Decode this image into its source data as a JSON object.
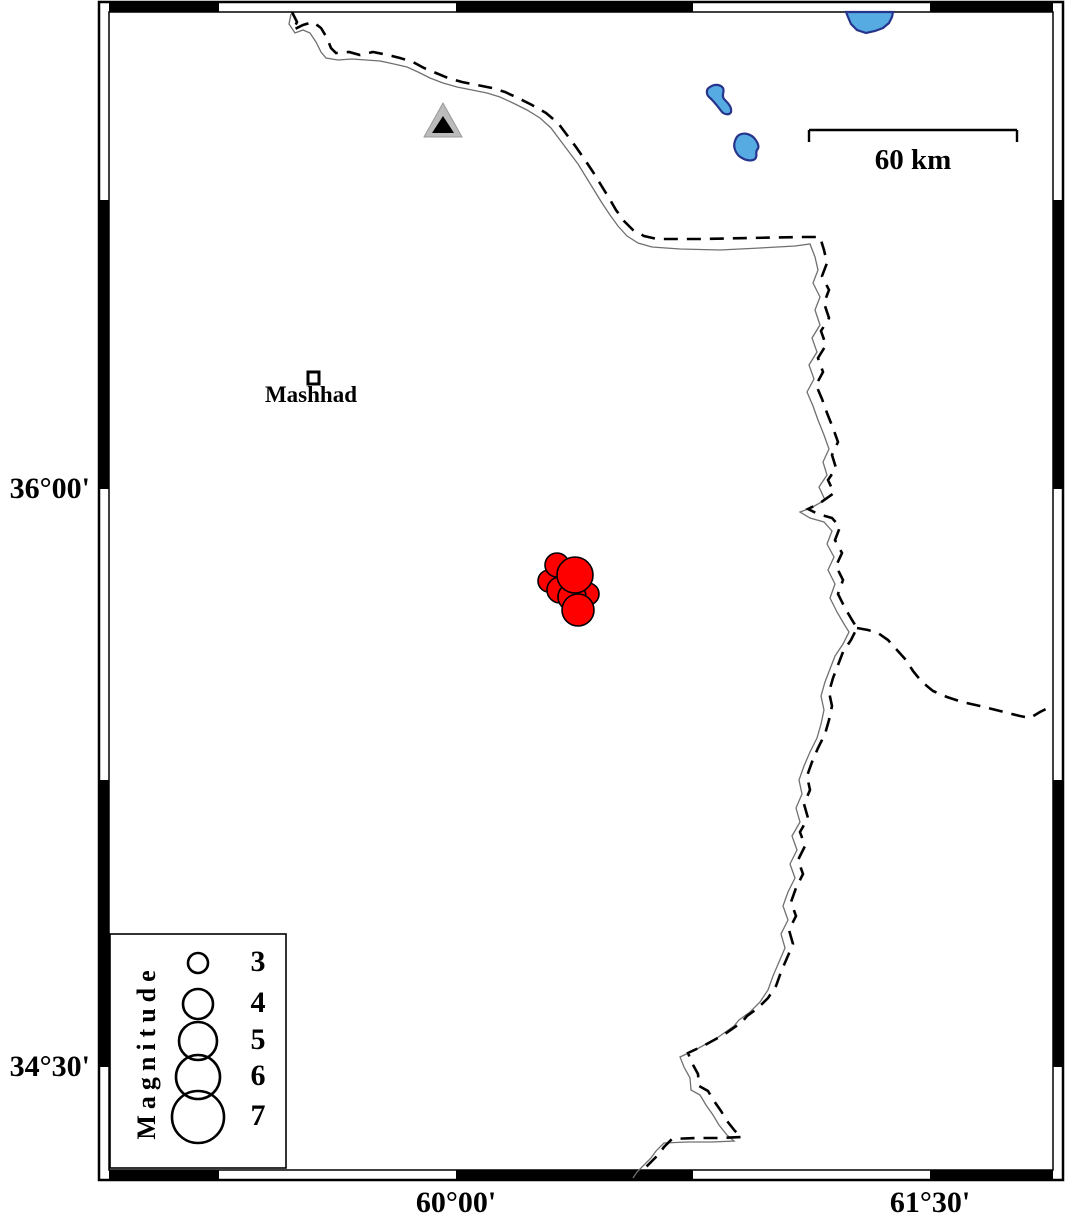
{
  "figure": {
    "type": "seismicity-map",
    "region": "around Mashhad, NE Iran"
  },
  "axis_labels": {
    "left": [
      {
        "text": "36°00'",
        "y": 489
      },
      {
        "text": "34°30'",
        "y": 1067
      }
    ],
    "bottom": [
      {
        "text": "60°00'",
        "x": 456
      },
      {
        "text": "61°30'",
        "x": 930
      }
    ]
  },
  "scale_bar": {
    "label": "60 km"
  },
  "city": {
    "label": "Mashhad"
  },
  "station_marker": {
    "shape": "triangle",
    "fill": "#bbbbbb",
    "inner": "#000000"
  },
  "legend": {
    "title": "Magnitude",
    "circle_cx": 198,
    "entries": [
      {
        "label": "3",
        "r": 10,
        "cy": 963
      },
      {
        "label": "4",
        "r": 15,
        "cy": 1004
      },
      {
        "label": "5",
        "r": 19,
        "cy": 1041
      },
      {
        "label": "6",
        "r": 22,
        "cy": 1077
      },
      {
        "label": "7",
        "r": 26,
        "cy": 1117
      }
    ]
  },
  "earthquakes": {
    "fill": "#ff0000",
    "stroke": "#000000",
    "points": [
      {
        "cx": 549,
        "cy": 581,
        "r": 11
      },
      {
        "cx": 557,
        "cy": 565,
        "r": 12
      },
      {
        "cx": 560,
        "cy": 590,
        "r": 13
      },
      {
        "cx": 588,
        "cy": 594,
        "r": 11
      },
      {
        "cx": 572,
        "cy": 597,
        "r": 14
      },
      {
        "cx": 578,
        "cy": 610,
        "r": 16
      },
      {
        "cx": 575,
        "cy": 575,
        "r": 18
      }
    ]
  },
  "colors": {
    "lake_fill": "#56abe3",
    "lake_stroke": "#27348b",
    "border_dash": "#000000",
    "river_line": "#707070",
    "frame_black": "#000000"
  }
}
